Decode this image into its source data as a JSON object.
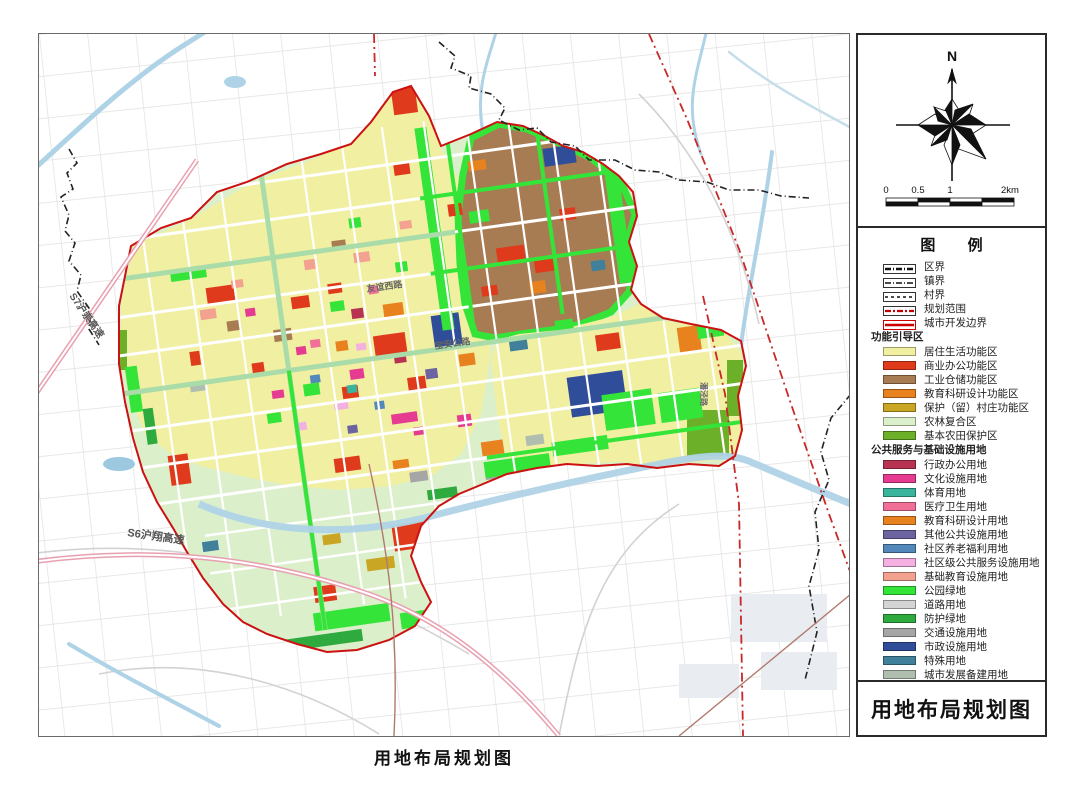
{
  "page": {
    "caption": "用地布局规划图"
  },
  "legend": {
    "title": "图  例",
    "map_title": "用地布局规划图",
    "compass": {
      "north_label": "N"
    },
    "scale_bar": {
      "labels": [
        "0",
        "0.5",
        "1",
        "2km"
      ]
    },
    "line_items": [
      {
        "label": "区界",
        "style": "black-bold-dash"
      },
      {
        "label": "镇界",
        "style": "black-dash-dot"
      },
      {
        "label": "村界",
        "style": "black-short-dash"
      },
      {
        "label": "规划范围",
        "style": "red-dash-dot",
        "color": "#c00000"
      },
      {
        "label": "城市开发边界",
        "style": "red-solid",
        "color": "#cc0000"
      }
    ],
    "sections": [
      {
        "header": "功能引导区",
        "items": [
          {
            "label": "居住生活功能区",
            "color": "#F1EFA2"
          },
          {
            "label": "商业办公功能区",
            "color": "#DF3A1B"
          },
          {
            "label": "工业仓储功能区",
            "color": "#A87C52"
          },
          {
            "label": "教育科研设计功能区",
            "color": "#E8821F"
          },
          {
            "label": "保护（留）村庄功能区",
            "color": "#C9A623"
          },
          {
            "label": "农林复合区",
            "color": "#DBEFCB"
          },
          {
            "label": "基本农田保护区",
            "color": "#6CB02A"
          }
        ]
      },
      {
        "header": "公共服务与基础设施用地",
        "items": [
          {
            "label": "行政办公用地",
            "color": "#B83352"
          },
          {
            "label": "文化设施用地",
            "color": "#E53B90"
          },
          {
            "label": "体育用地",
            "color": "#39B49D"
          },
          {
            "label": "医疗卫生用地",
            "color": "#F07098"
          },
          {
            "label": "教育科研设计用地",
            "color": "#E8821F"
          },
          {
            "label": "其他公共设施用地",
            "color": "#6B64A1"
          },
          {
            "label": "社区养老福利用地",
            "color": "#5288BA"
          },
          {
            "label": "社区级公共服务设施用地",
            "color": "#F5B0E2"
          },
          {
            "label": "基础教育设施用地",
            "color": "#F2A28E"
          },
          {
            "label": "公园绿地",
            "color": "#35E438"
          },
          {
            "label": "道路用地",
            "color": "#D4D4D4"
          },
          {
            "label": "防护绿地",
            "color": "#2FAA3E"
          },
          {
            "label": "交通设施用地",
            "color": "#A6A6A6"
          },
          {
            "label": "市政设施用地",
            "color": "#2F4D99"
          },
          {
            "label": "特殊用地",
            "color": "#41809A"
          },
          {
            "label": "城市发展备建用地",
            "color": "#B0BEAF"
          }
        ]
      }
    ]
  },
  "map": {
    "labels": {
      "s7": "S7沪崇高速",
      "s6": "S6沪翔高速",
      "youyi": "友谊西路",
      "baoan": "宝安公路",
      "panjing": "潘泾路"
    }
  }
}
